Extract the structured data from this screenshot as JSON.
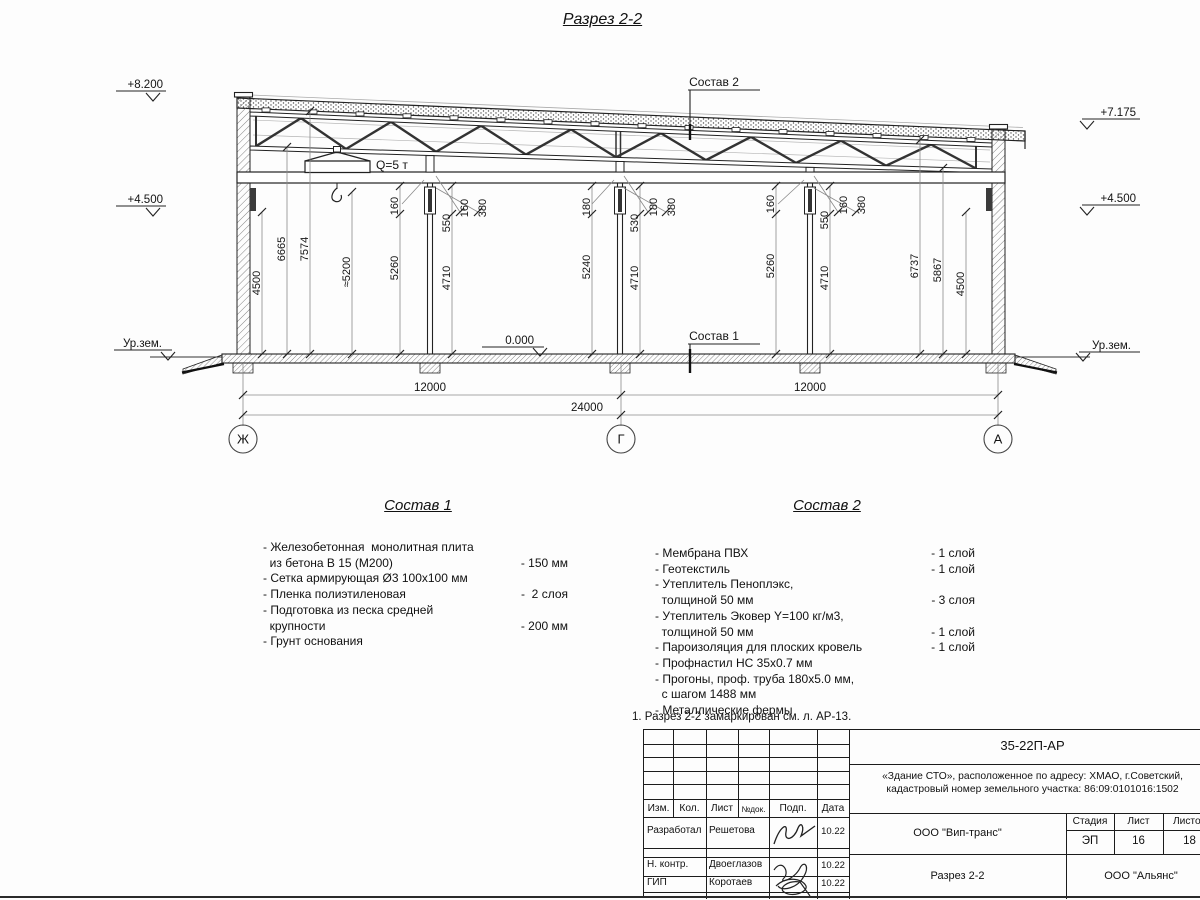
{
  "page_title": "Разрез 2-2",
  "drawing": {
    "crane_label": "Q=5 т",
    "elev_left_top": "+8.200",
    "elev_left_mid": "+4.500",
    "elev_right_top": "+7.175",
    "elev_right_mid": "+4.500",
    "elev_zero": "0.000",
    "ground_left": "Ур.зем.",
    "ground_right": "Ур.зем.",
    "leader1": "Состав 1",
    "leader2": "Состав 2",
    "dims_h": {
      "span_left": "12000",
      "span_right": "12000",
      "total": "24000"
    },
    "axes": {
      "left": "Ж",
      "mid": "Г",
      "right": "А"
    },
    "dims_v": {
      "v4500l": "4500",
      "v6665": "6665",
      "v7574": "7574",
      "v5200": "≈5200",
      "v5260a": "5260",
      "v160a": "160",
      "v550a": "550",
      "v160b": "160",
      "v380a": "380",
      "v4710a": "4710",
      "v180a": "180",
      "v5240": "5240",
      "v530": "530",
      "v180b": "180",
      "v380b": "380",
      "v4710b": "4710",
      "v160c": "160",
      "v5260b": "5260",
      "v550b": "550",
      "v160d": "160",
      "v380c": "380",
      "v4710c": "4710",
      "v6737": "6737",
      "v5867": "5867",
      "v4500r": "4500"
    }
  },
  "sostav1": {
    "title": "Состав 1",
    "lines": [
      {
        "text": "- Железобетонная  монолитная плита",
        "value": ""
      },
      {
        "text": "  из бетона В 15 (М200)",
        "value": "- 150 мм"
      },
      {
        "text": "- Сетка армирующая Ø3 100x100 мм",
        "value": ""
      },
      {
        "text": "- Пленка полиэтиленовая",
        "value": "-  2 слоя"
      },
      {
        "text": "- Подготовка из песка средней",
        "value": ""
      },
      {
        "text": "  крупности",
        "value": "- 200 мм"
      },
      {
        "text": "- Грунт основания",
        "value": ""
      }
    ]
  },
  "sostav2": {
    "title": "Состав 2",
    "lines": [
      {
        "text": "- Мембрана ПВХ",
        "value": "- 1 слой"
      },
      {
        "text": "- Геотекстиль",
        "value": "- 1 слой"
      },
      {
        "text": "- Утеплитель Пеноплэкс,",
        "value": ""
      },
      {
        "text": "  толщиной 50 мм",
        "value": "- 3 слоя"
      },
      {
        "text": "- Утеплитель Эковер Y=100 кг/м3,",
        "value": ""
      },
      {
        "text": "  толщиной 50 мм",
        "value": "- 1 слой"
      },
      {
        "text": "- Пароизоляция для плоских кровель",
        "value": "- 1 слой"
      },
      {
        "text": "- Профнастил НС 35x0.7 мм",
        "value": ""
      },
      {
        "text": "- Прогоны, проф. труба 180x5.0 мм,",
        "value": ""
      },
      {
        "text": "  с шагом 1488 мм",
        "value": ""
      },
      {
        "text": "- Металлические фермы",
        "value": ""
      }
    ]
  },
  "note": "1. Разрез 2-2 замаркирован см. л. АР-13.",
  "titleblock": {
    "doc_number": "35-22П-АР",
    "object_line1": "«Здание СТО», расположенное по адресу: ХМАО, г.Советский,",
    "object_line2": "кадастровый номер земельного участка: 86:09:0101016:1502",
    "header": {
      "izm": "Изм.",
      "kol": "Кол.",
      "list": "Лист",
      "ndok": "№док.",
      "podp": "Подп.",
      "data": "Дата"
    },
    "rows": [
      {
        "role": "Разработал",
        "name": "Решетова",
        "date": "10.22"
      },
      {
        "role": "Н. контр.",
        "name": "Двоеглазов",
        "date": "10.22"
      },
      {
        "role": "ГИП",
        "name": "Коротаев",
        "date": "10.22"
      }
    ],
    "company_top": "ООО \"Вип-транс\"",
    "sheet_title": "Разрез 2-2",
    "company_bottom": "ООО \"Альянс\"",
    "stage_label": "Стадия",
    "sheet_label": "Лист",
    "sheets_label": "Листов",
    "stage_value": "ЭП",
    "sheet_value": "16",
    "sheets_value": "18"
  }
}
